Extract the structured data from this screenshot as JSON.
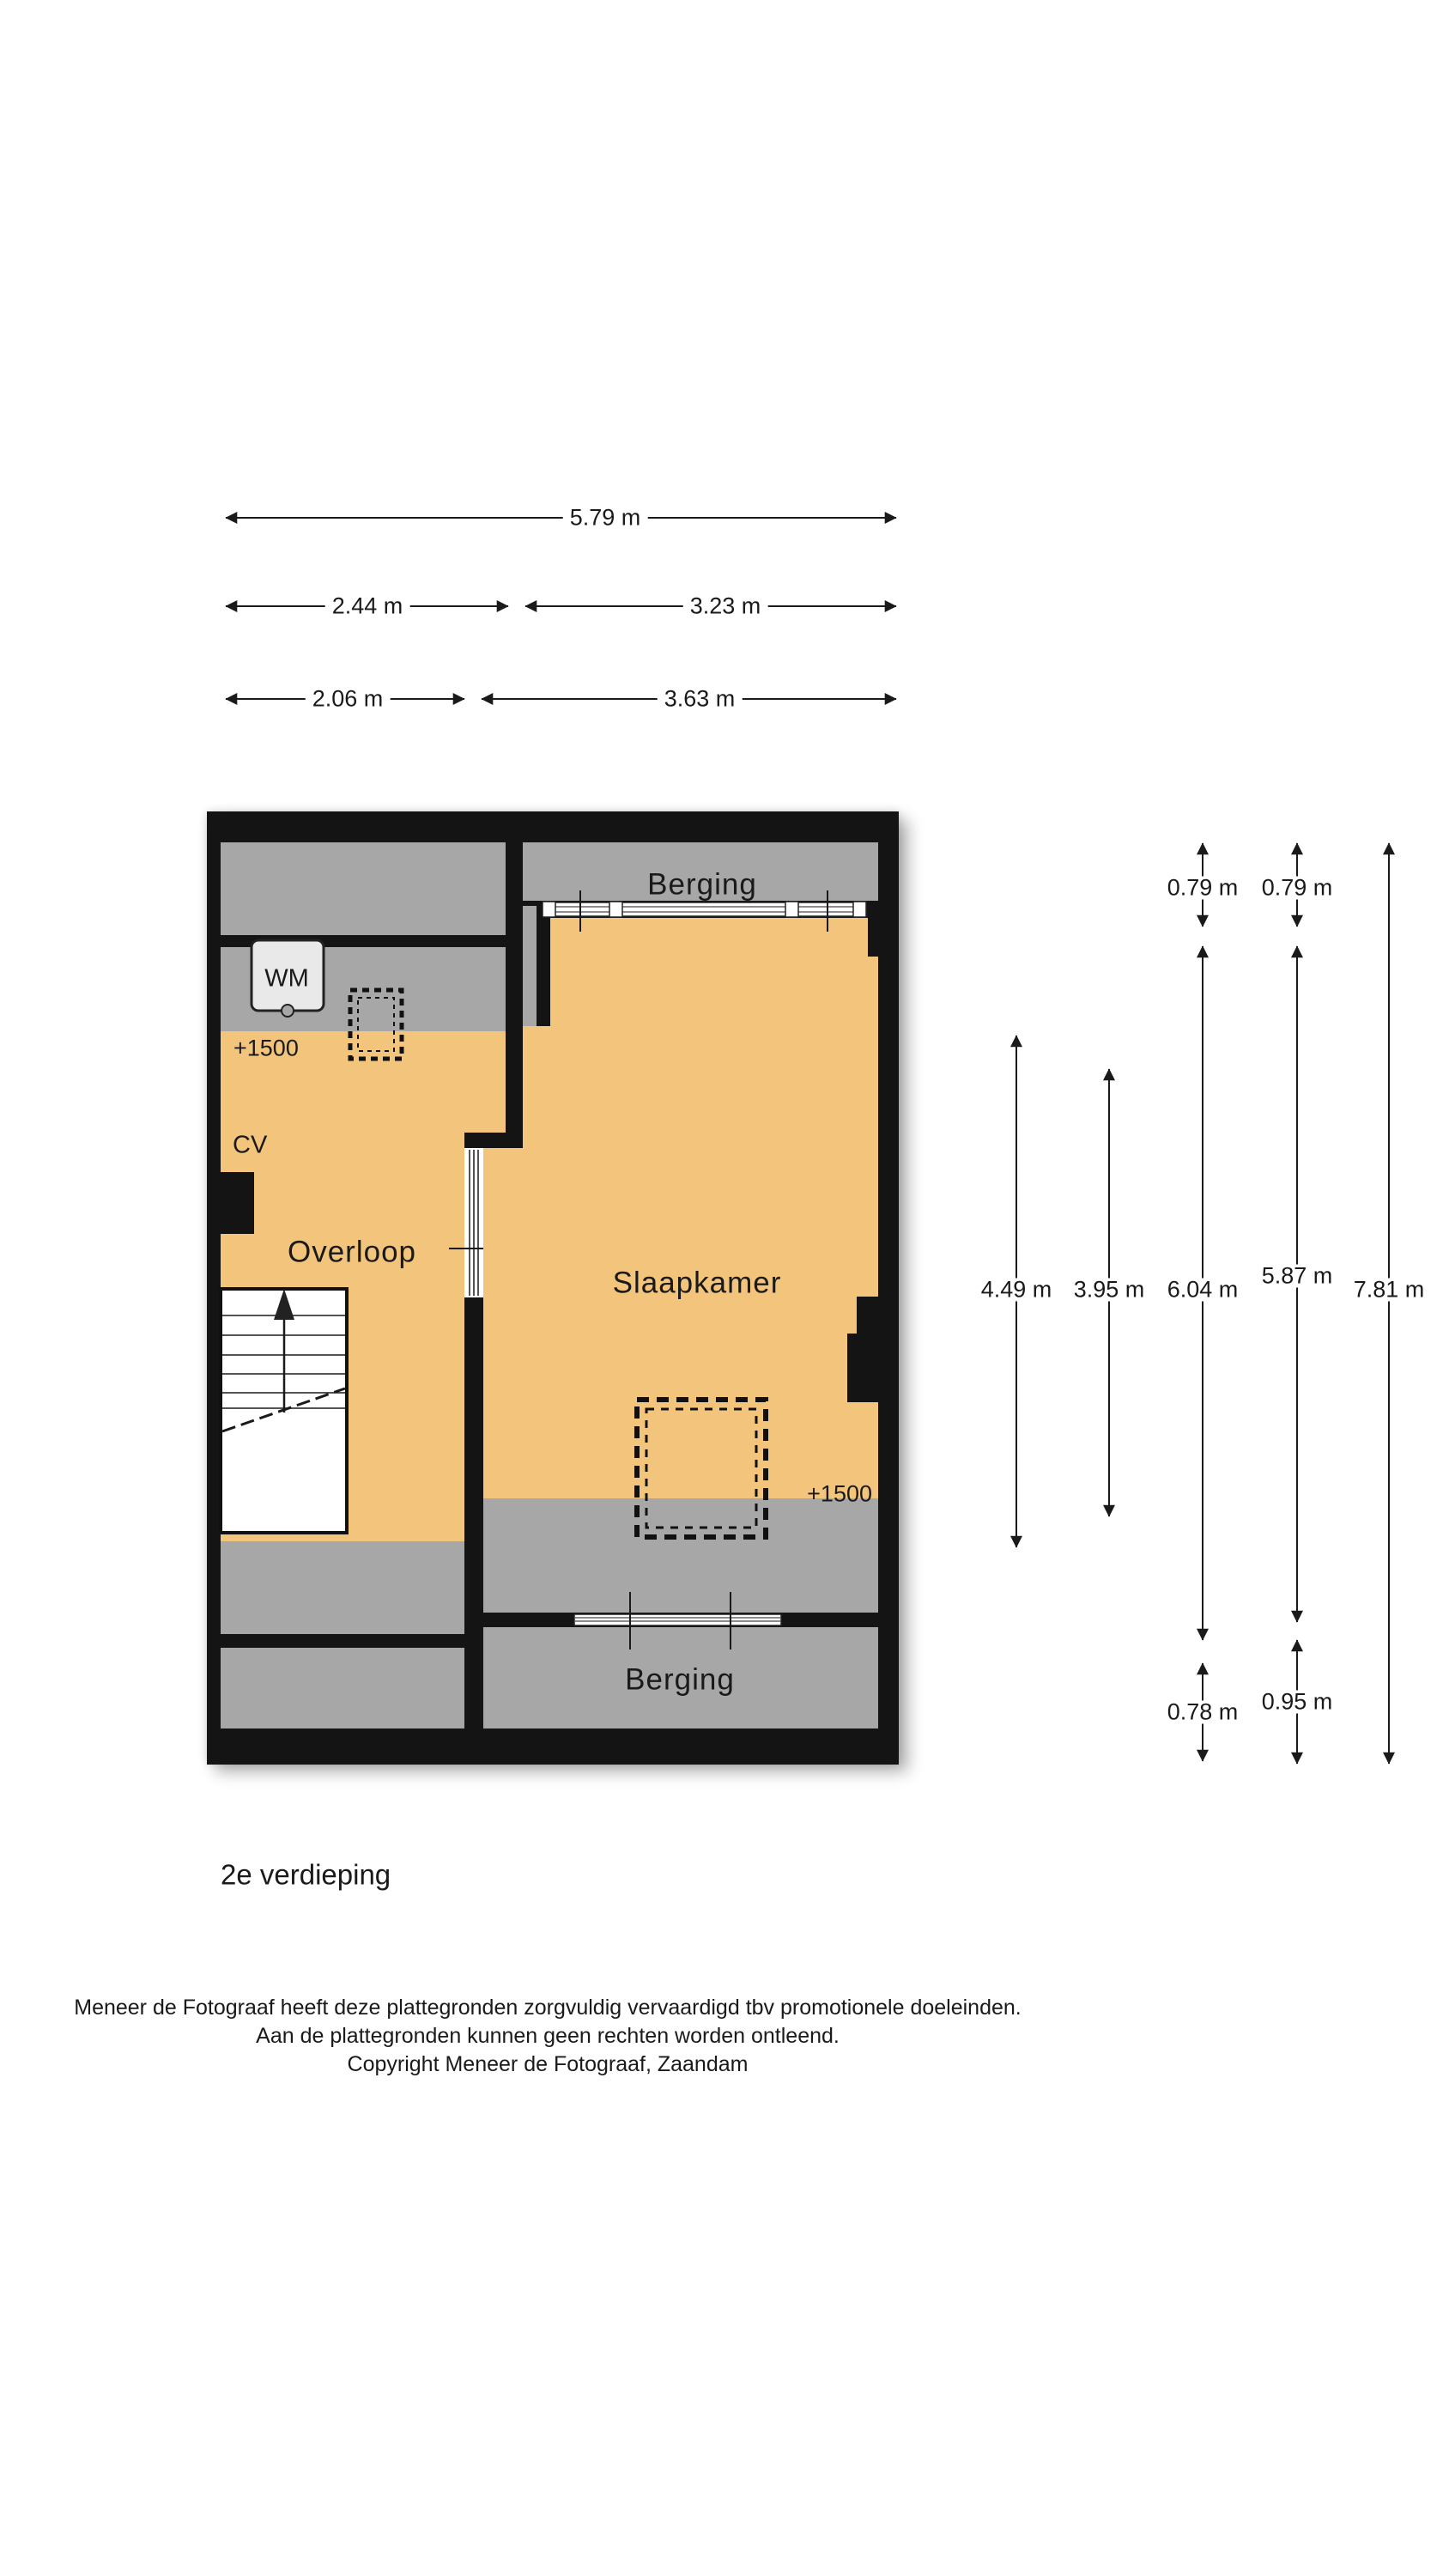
{
  "title": {
    "floor_label": "2e verdieping"
  },
  "rooms": {
    "berging_top": "Berging",
    "slaapkamer": "Slaapkamer",
    "overloop": "Overloop",
    "berging_bottom": "Berging"
  },
  "markers": {
    "wm": "WM",
    "cv": "CV",
    "height_left": "+1500",
    "height_right": "+1500"
  },
  "dimensions_top": {
    "total": "5.79 m",
    "row2_left": "2.44 m",
    "row2_right": "3.23 m",
    "row3_left": "2.06 m",
    "row3_right": "3.63 m"
  },
  "dimensions_right": {
    "v_079a": "0.79 m",
    "v_079b": "0.79 m",
    "v_449": "4.49 m",
    "v_395": "3.95 m",
    "v_604": "6.04 m",
    "v_587": "5.87 m",
    "v_781": "7.81 m",
    "v_078": "0.78 m",
    "v_095": "0.95 m"
  },
  "footer": {
    "line1": "Meneer de Fotograaf heeft deze plattegronden zorgvuldig vervaardigd tbv promotionele doeleinden.",
    "line2": "Aan de plattegronden kunnen geen rechten worden ontleend.",
    "line3": "Copyright Meneer de Fotograaf, Zaandam"
  },
  "colors": {
    "wall": "#141414",
    "floor_orange": "#F3C47B",
    "reduced_height_gray": "#A7A7A7",
    "appliance_fill": "#E9E9E9",
    "background": "#FFFFFF"
  }
}
